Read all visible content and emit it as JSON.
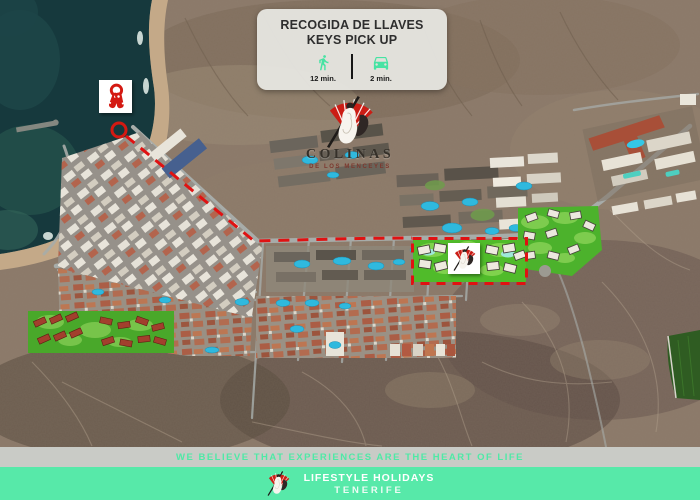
{
  "info_card": {
    "title_line1": "RECOGIDA DE LLAVES",
    "title_line2": "KEYS PICK UP",
    "walk_time": "12 min.",
    "drive_time": "2 min.",
    "icon_color": "#46E3A3"
  },
  "resort_logo": {
    "name": "COLINAS",
    "subtitle": "DE LOS MENCEYES"
  },
  "map": {
    "style": "satellite",
    "route_color": "#E01212",
    "route_style": "dashed",
    "highlight_plot_color": "#50BB2A",
    "markers": [
      "keys-pickup-box",
      "start-circle-marker",
      "dashed-route",
      "colinas-plot-highlight",
      "colinas-plot-logo-box"
    ]
  },
  "tagline": {
    "text": "WE BELIEVE THAT EXPERIENCES ARE THE HEART OF LIFE",
    "color": "#4FE9A6"
  },
  "footer": {
    "line1": "LIFESTYLE HOLIDAYS",
    "line2": "TENERIFE",
    "background": "#57E9A9"
  }
}
